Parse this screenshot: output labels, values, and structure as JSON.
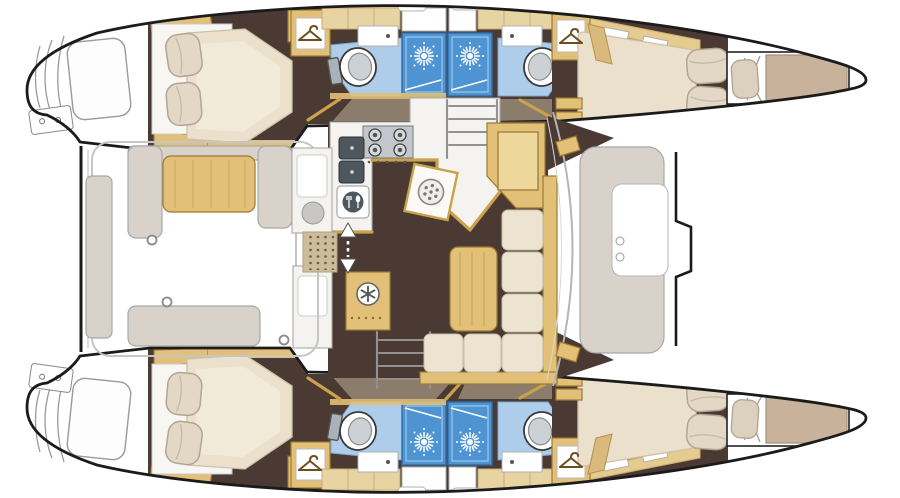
{
  "diagram": {
    "kind": "catamaran-interior-floor-plan",
    "orientation": {
      "bow": "right",
      "stern": "left"
    },
    "hulls": 2,
    "features": {
      "double_bed_cabins": 4,
      "bow_berths": 2,
      "toilets": 4,
      "shower_stalls": 4,
      "bathroom_washbasins": 4,
      "wardrobes": 4,
      "stair_flights": 2,
      "galley_burners": 4,
      "galley_sinks": 2,
      "cockpit_tables": 1,
      "salon_tables": 1,
      "cockpit_benches": 3
    },
    "icons": [
      {
        "name": "hanger-icon",
        "depicts": "clothes hanger in wardrobe",
        "count": 4
      },
      {
        "name": "sunburst-shower-icon",
        "depicts": "shower rose in shower stall",
        "count": 4
      },
      {
        "name": "snowflake-icon",
        "depicts": "refrigerator",
        "count": 1
      },
      {
        "name": "drum-icon",
        "depicts": "round appliance drum",
        "count": 1
      },
      {
        "name": "oven-icon",
        "depicts": "oven with cutlery",
        "count": 1
      },
      {
        "name": "burner-icon",
        "depicts": "stove burner",
        "count": 4
      },
      {
        "name": "double-arrow-icon",
        "depicts": "companionway entry direction",
        "count": 1
      },
      {
        "name": "toilet-icon",
        "depicts": "marine toilet",
        "count": 4
      },
      {
        "name": "deck-hatch-pill",
        "depicts": "deck hatch",
        "count": 8
      }
    ],
    "colors": {
      "outline": "#1b1b1b",
      "floor": "#4a3a33",
      "wood": "#e2c078",
      "woodEdge": "#9c7a33",
      "beige": "#e8d3a2",
      "cream": "#ece4d0",
      "matt": "#eae0cb",
      "berth": "#c8b29b",
      "bathFloor": "#aecdea",
      "shower": "#4f94d2",
      "bench": "#d8d2ca",
      "counter": "#f4f3ef"
    }
  }
}
